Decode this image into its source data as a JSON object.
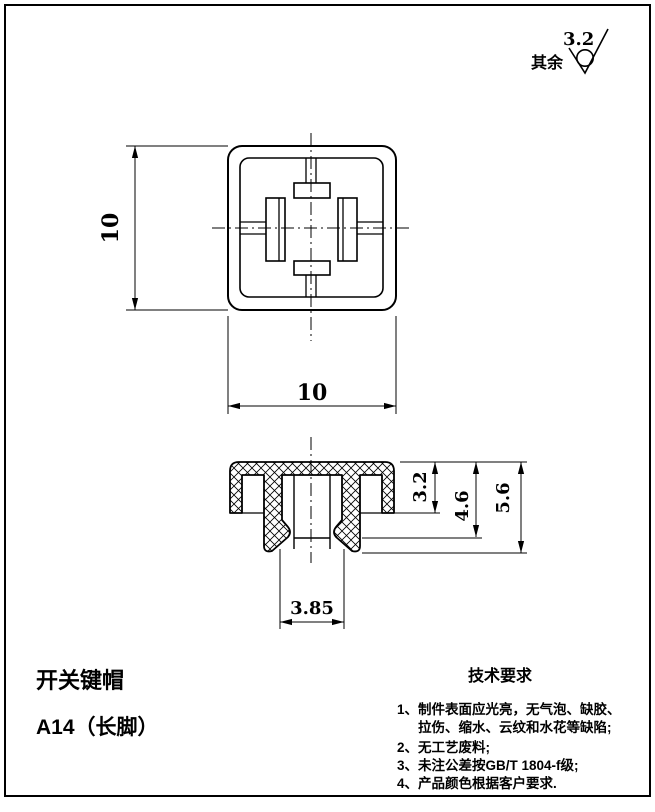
{
  "drawing": {
    "part_name": "开关键帽",
    "part_model": "A14（长脚）",
    "roughness": {
      "label": "其余",
      "value": "3.2"
    },
    "top_view": {
      "height_dim": "10",
      "width_dim": "10"
    },
    "section_view": {
      "cap_depth_dim": "3.2",
      "inner_depth_dim": "4.6",
      "total_height_dim": "5.6",
      "stem_width_dim": "3.85"
    },
    "tech_requirements": {
      "title": "技术要求",
      "lines": [
        "1、制件表面应光亮，无气泡、缺胶、",
        "拉伤、缩水、云纹和水花等缺陷;",
        "2、无工艺废料;",
        "3、未注公差按GB/T 1804-f级;",
        "4、产品颜色根据客户要求."
      ]
    },
    "colors": {
      "ink": "#000000",
      "paper": "#ffffff"
    }
  }
}
